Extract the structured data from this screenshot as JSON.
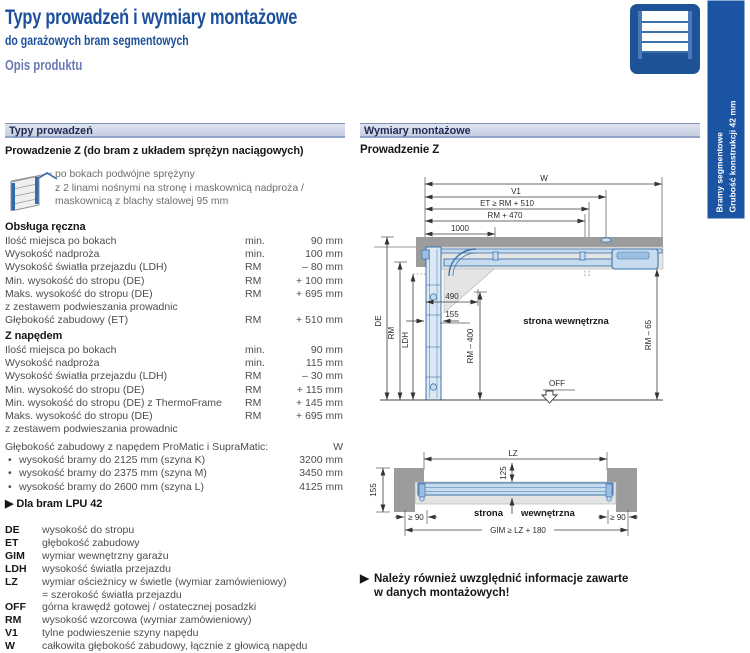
{
  "page": {
    "title": "Typy prowadzeń i wymiary montażowe",
    "subtitle": "do garażowych bram segmentowych",
    "section": "Opis produktu"
  },
  "side_tab": {
    "line1": "Bramy segmentowe",
    "line2": "Grubość konstrukcji 42 mm"
  },
  "left": {
    "header": "Typy prowadzeń",
    "subheader": "Prowadzenie Z (do bram z układem sprężyn naciągowych)",
    "intro_line1": "po bokach podwójne sprężyny",
    "intro_line2": "z 2 linami nośnymi na stronę i maskownicą nadproża /",
    "intro_line3": "maskownicą z blachy stalowej 95 mm",
    "manual": {
      "title": "Obsługa ręczna",
      "rows": [
        {
          "label": "Ilość miejsca po bokach",
          "ref": "min.",
          "value": "90 mm"
        },
        {
          "label": "Wysokość nadproża",
          "ref": "min.",
          "value": "100 mm"
        },
        {
          "label": "Wysokość światła przejazdu (LDH)",
          "ref": "RM",
          "value": "– 80 mm"
        },
        {
          "label": "Min. wysokość do stropu (DE)",
          "ref": "RM",
          "value": "+ 100 mm"
        },
        {
          "label": "Maks. wysokość do stropu (DE)",
          "ref": "RM",
          "value": "+ 695 mm"
        },
        {
          "label": "z zestawem podwieszania prowadnic",
          "ref": "",
          "value": ""
        },
        {
          "label": "Głębokość zabudowy (ET)",
          "ref": "RM",
          "value": "+ 510 mm"
        }
      ]
    },
    "powered": {
      "title": "Z napędem",
      "rows": [
        {
          "label": "Ilość miejsca po bokach",
          "ref": "min.",
          "value": "90 mm"
        },
        {
          "label": "Wysokość nadproża",
          "ref": "min.",
          "value": "115 mm"
        },
        {
          "label": "Wysokość światła przejazdu (LDH)",
          "ref": "RM",
          "value": "– 30 mm"
        },
        {
          "label": "Min. wysokość do stropu (DE)",
          "ref": "RM",
          "value": "+ 115 mm"
        },
        {
          "label": "Min. wysokość do stropu (DE) z ThermoFrame",
          "ref": "RM",
          "value": "+ 145 mm"
        },
        {
          "label": "Maks. wysokość do stropu (DE)",
          "ref": "RM",
          "value": "+ 695 mm"
        },
        {
          "label": "z zestawem podwieszania prowadnic",
          "ref": "",
          "value": ""
        }
      ]
    },
    "depth": {
      "label": "Głębokość zabudowy z napędem ProMatic i SupraMatic:",
      "value_header": "W",
      "bullet": "•",
      "rows": [
        {
          "label": "wysokość bramy do 2125 mm (szyna K)",
          "value": "3200 mm"
        },
        {
          "label": "wysokość bramy do 2375 mm (szyna M)",
          "value": "3450 mm"
        },
        {
          "label": "wysokość bramy do 2600 mm (szyna L)",
          "value": "4125 mm"
        }
      ]
    },
    "lpu_marker": "▶",
    "lpu_note": "Dla bram LPU 42",
    "abbreviations": [
      {
        "abbr": "DE",
        "desc": "wysokość do stropu"
      },
      {
        "abbr": "ET",
        "desc": "głębokość zabudowy"
      },
      {
        "abbr": "GIM",
        "desc": "wymiar wewnętrzny garażu"
      },
      {
        "abbr": "LDH",
        "desc": "wysokość światła przejazdu"
      },
      {
        "abbr": "LZ",
        "desc": "wymiar ościeżnicy w świetle (wymiar zamówieniowy)",
        "desc2": "= szerokość światła przejazdu"
      },
      {
        "abbr": "OFF",
        "desc": "górna krawędź gotowej / ostatecznej posadzki"
      },
      {
        "abbr": "RM",
        "desc": "wysokość wzorcowa (wymiar zamówieniowy)"
      },
      {
        "abbr": "V1",
        "desc": "tylne podwieszenie szyny napędu"
      },
      {
        "abbr": "W",
        "desc": "całkowita głębokość zabudowy, łącznie z głowicą napędu"
      }
    ]
  },
  "right": {
    "header": "Wymiary montażowe",
    "subheader": "Prowadzenie Z",
    "note_marker": "▶",
    "note_line1": "Należy również uwzględnić informacje zawarte",
    "note_line2": "w danych montażowych!",
    "diagram_side": {
      "dim_w": "W",
      "dim_v1": "V1",
      "dim_et": "ET ≥ RM + 510",
      "dim_rm470": "RM + 470",
      "dim_1000": "1000",
      "dim_490": "490",
      "dim_155": "155",
      "dim_de": "DE",
      "dim_rm": "RM",
      "dim_ldh": "LDH",
      "dim_rm400": "RM – 400",
      "dim_rm65": "RM – 65",
      "label_inside": "strona wewnętrzna",
      "label_off": "OFF"
    },
    "diagram_plan": {
      "dim_lz": "LZ",
      "dim_125": "125",
      "dim_155": "155",
      "dim_90_left": "≥ 90",
      "dim_90_right": "≥ 90",
      "dim_gim": "GIM ≥ LZ + 180",
      "label_left": "strona",
      "label_right": "wewnętrzna"
    }
  },
  "colors": {
    "brand_blue": "#1c4f9c",
    "tab_blue": "#1b54a3",
    "bar_bg": "#c5cde1",
    "drawing_blue": "#3f74ad",
    "ceiling_gray": "#9c9c9c"
  }
}
